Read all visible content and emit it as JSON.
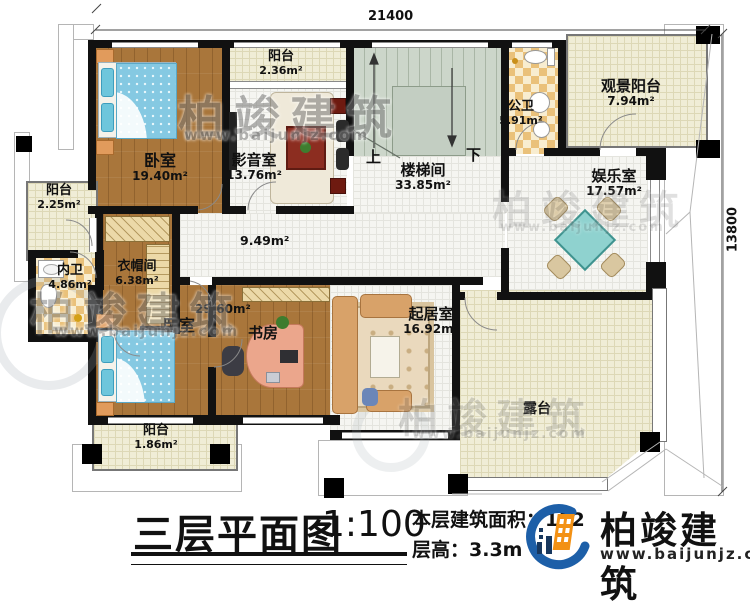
{
  "dimensions": {
    "top": "21400",
    "right": "13800"
  },
  "annotations": {
    "up": "上",
    "down": "下",
    "hall_area": "9.49m²"
  },
  "rooms": {
    "bedroom1": {
      "name": "卧室",
      "area": "19.40m²"
    },
    "balcony_top": {
      "name": "阳台",
      "area": "2.36m²"
    },
    "media": {
      "name": "影音室",
      "area": "13.76m²"
    },
    "stairwell": {
      "name": "楼梯间",
      "area": "33.85m²"
    },
    "bath_public": {
      "name": "公卫",
      "area": "5.91m²"
    },
    "view_balcony": {
      "name": "观景阳台",
      "area": "7.94m²"
    },
    "entertainment": {
      "name": "娱乐室",
      "area": "17.57m²"
    },
    "balcony_left": {
      "name": "阳台",
      "area": "2.25m²"
    },
    "bath_inner": {
      "name": "内卫",
      "area": "4.86m²"
    },
    "cloakroom": {
      "name": "衣帽间",
      "area": "6.38m²"
    },
    "bedroom2": {
      "name": "卧室",
      "area": "29.60m²"
    },
    "study": {
      "name": "书房"
    },
    "living": {
      "name": "起居室",
      "area": "16.92m²"
    },
    "terrace": {
      "name": "露台"
    },
    "balcony_bottom": {
      "name": "阳台",
      "area": "1.86m²"
    }
  },
  "watermark": {
    "brand": "柏竣建筑",
    "url": "www.baijunjz.com"
  },
  "footer": {
    "title": "三层平面图",
    "scale": "1:100",
    "area_label": "本层建筑面积：",
    "area_value": "182",
    "area_sup": "²",
    "height_label": "层高：",
    "height_value": "3.3m",
    "brand": "柏竣建筑",
    "brand_url": "www.baijunjz.com"
  },
  "colors": {
    "wall": "#111111",
    "wood": "#a9763b",
    "cream_tile": "#f0edd6",
    "white_tile": "#f5f5f1",
    "checker_a": "#eac17a",
    "checker_b": "#f8edd0",
    "stair": "#ccd6ca",
    "bed_blue": "#85c9e2",
    "table_teal": "#8fd2cf",
    "logo_blue": "#1d5fa8",
    "logo_orange": "#f39114"
  }
}
